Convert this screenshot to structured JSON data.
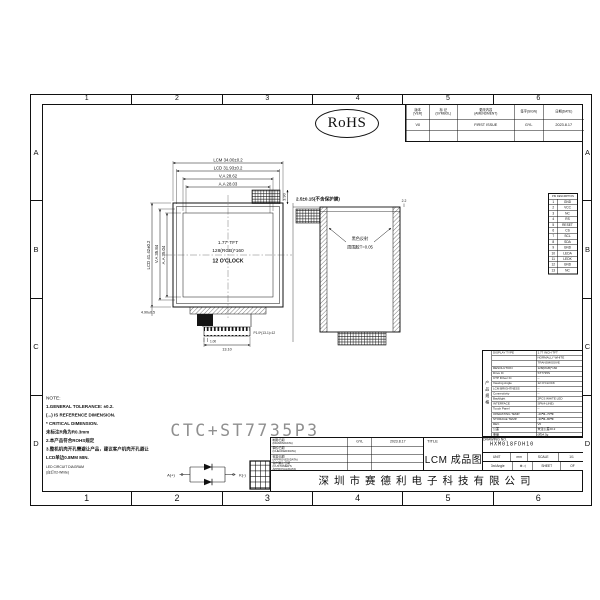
{
  "sheet": {
    "grid_columns": [
      "1",
      "2",
      "3",
      "4",
      "5",
      "6"
    ],
    "grid_rows": [
      "A",
      "B",
      "C",
      "D"
    ],
    "rohs_label": "RoHS",
    "watermark": "CTC+ST7735P3"
  },
  "revision_table": {
    "headers": [
      "版本\n[VER]",
      "标 记\n(SYMBOL)",
      "更改内容\n(AMENDMENT)",
      "签字(SIGN)",
      "日期(DATE)"
    ],
    "rows": [
      {
        "ver": "V0",
        "symbol": "",
        "amendment": "FIRST ISSUE",
        "sign": "GYL",
        "date": "2023.8.17"
      },
      {
        "ver": "",
        "symbol": "",
        "amendment": "",
        "sign": "",
        "date": ""
      }
    ]
  },
  "front_view": {
    "dim_lcm_w": "LCM 34.00±0.2",
    "dim_lcd_w": "LCD 31.93±0.2",
    "dim_va_w": "V.A 28.62",
    "dim_aa_w": "A.A 28.03",
    "dim_tab_h": "3.90",
    "dim_lcd_h": "LCD 41.42±0.2",
    "dim_va_h": "V.A 35.84",
    "dim_aa_h": "A.A 35.04",
    "dim_bottom": "4.90±0.5",
    "screen_line1": "1.77' TFT",
    "screen_line2": "128(RGB)*160",
    "screen_line3": "12 O'CLOCK",
    "dim_pin_width": "1.00",
    "dim_pitch": "P1.0*(13-1)=12",
    "dim_conn_width": "13.10"
  },
  "side_view": {
    "dim_thickness": "2.5±0.15(不含保护膜)",
    "dim_top_right": "2.2",
    "note_line1": "黑色反射",
    "note_line2": "周围胶T=0.05"
  },
  "pin_table": {
    "header": "PIN DESCRIPTION",
    "rows": [
      {
        "no": "1",
        "name": "GND"
      },
      {
        "no": "2",
        "name": "VCC"
      },
      {
        "no": "3",
        "name": "NC"
      },
      {
        "no": "4",
        "name": "RS"
      },
      {
        "no": "5",
        "name": "RESET"
      },
      {
        "no": "6",
        "name": "CS"
      },
      {
        "no": "7",
        "name": "SCL"
      },
      {
        "no": "8",
        "name": "SDA"
      },
      {
        "no": "9",
        "name": "GND"
      },
      {
        "no": "10",
        "name": "LEDA"
      },
      {
        "no": "11",
        "name": "LEDK"
      },
      {
        "no": "12",
        "name": "GND"
      },
      {
        "no": "13",
        "name": "NC"
      }
    ]
  },
  "notes": {
    "title": "NOTE:",
    "lines": [
      "1.GENERAL TOLERANCE: ±0.2.",
      "   (...) IS REFERENCE DIMENSION.",
      "   * CRITICAL DIMENSION.",
      "   未标注R角为R0.3mm",
      "2.本产品符合ROHS规定",
      "3.整机机壳开孔需避让产品，建议客户机壳开孔避让",
      "LCD单边0.8MM MIN."
    ]
  },
  "led_diagram": {
    "title_line1": "LED CIRCUIT DIAGRAM",
    "title_line2": "(白灯X2-White)",
    "anode": "A(+)",
    "cathode": "K(-)"
  },
  "approval_block": {
    "rows": [
      {
        "label": "制图/日期\n(DRAWN/DATA)",
        "sign": "GYL",
        "date": "2023.8.17"
      },
      {
        "label": "审核/日期\n(CHECKED/DATA)",
        "sign": "",
        "date": ""
      },
      {
        "label": "核准/日期\n(APPROVED/DATA)",
        "sign": "",
        "date": ""
      },
      {
        "label": "客户确认/日期\n(CUSTOMER'S\nAPPROVAL/DATA)",
        "sign": "",
        "date": ""
      }
    ]
  },
  "title_block": {
    "title_label": "TITLE",
    "title": "LCM 成品图",
    "company": "深圳市赛德利电子科技有限公司",
    "drawing_no_label": "DRAWING NO.",
    "drawing_no": "HXM018FDH10",
    "unit_label": "UNIT",
    "unit_value": "mm",
    "scale_label": "SCALE",
    "scale_value": "1/1",
    "angle_label": "3rd Angle",
    "projection_symbol": "⊕ ◁",
    "sheet_label": "SHEET",
    "of_label": "OF"
  },
  "spec_table": {
    "side_label": "产品规格",
    "rows": [
      {
        "label": "DISPLAY TYPE",
        "value": "1.77 INCH TFT"
      },
      {
        "label": "",
        "value": "NORMALLY WHITE"
      },
      {
        "label": "",
        "value": "TRANSMISSIVE"
      },
      {
        "label": "RESOLUTION",
        "value": "128(RGB)*160"
      },
      {
        "label": "Drive IC",
        "value": "ST7735S"
      },
      {
        "label": "CTP Driver IC",
        "value": "--"
      },
      {
        "label": "Viewing Angle",
        "value": "12 O'CLOCK"
      },
      {
        "label": "LCM BRIGHTNESS",
        "value": "--"
      },
      {
        "label": "Connectivity",
        "value": "--"
      },
      {
        "label": "Backlight",
        "value": "2PCS WHITE LED"
      },
      {
        "label": "INTERFACE",
        "value": "SPI(4-LINE)"
      },
      {
        "label": "Touch Panel",
        "value": "--"
      },
      {
        "label": "OPERATING TEMP.",
        "value": "-20℃~70℃"
      },
      {
        "label": "STORAGE TEMP.",
        "value": "-30℃~80℃"
      },
      {
        "label": "REV.",
        "value": "V0"
      },
      {
        "label": "公差",
        "value": "未注公差±0.2"
      },
      {
        "label": "重量",
        "value": "(约)4.5g"
      }
    ]
  }
}
